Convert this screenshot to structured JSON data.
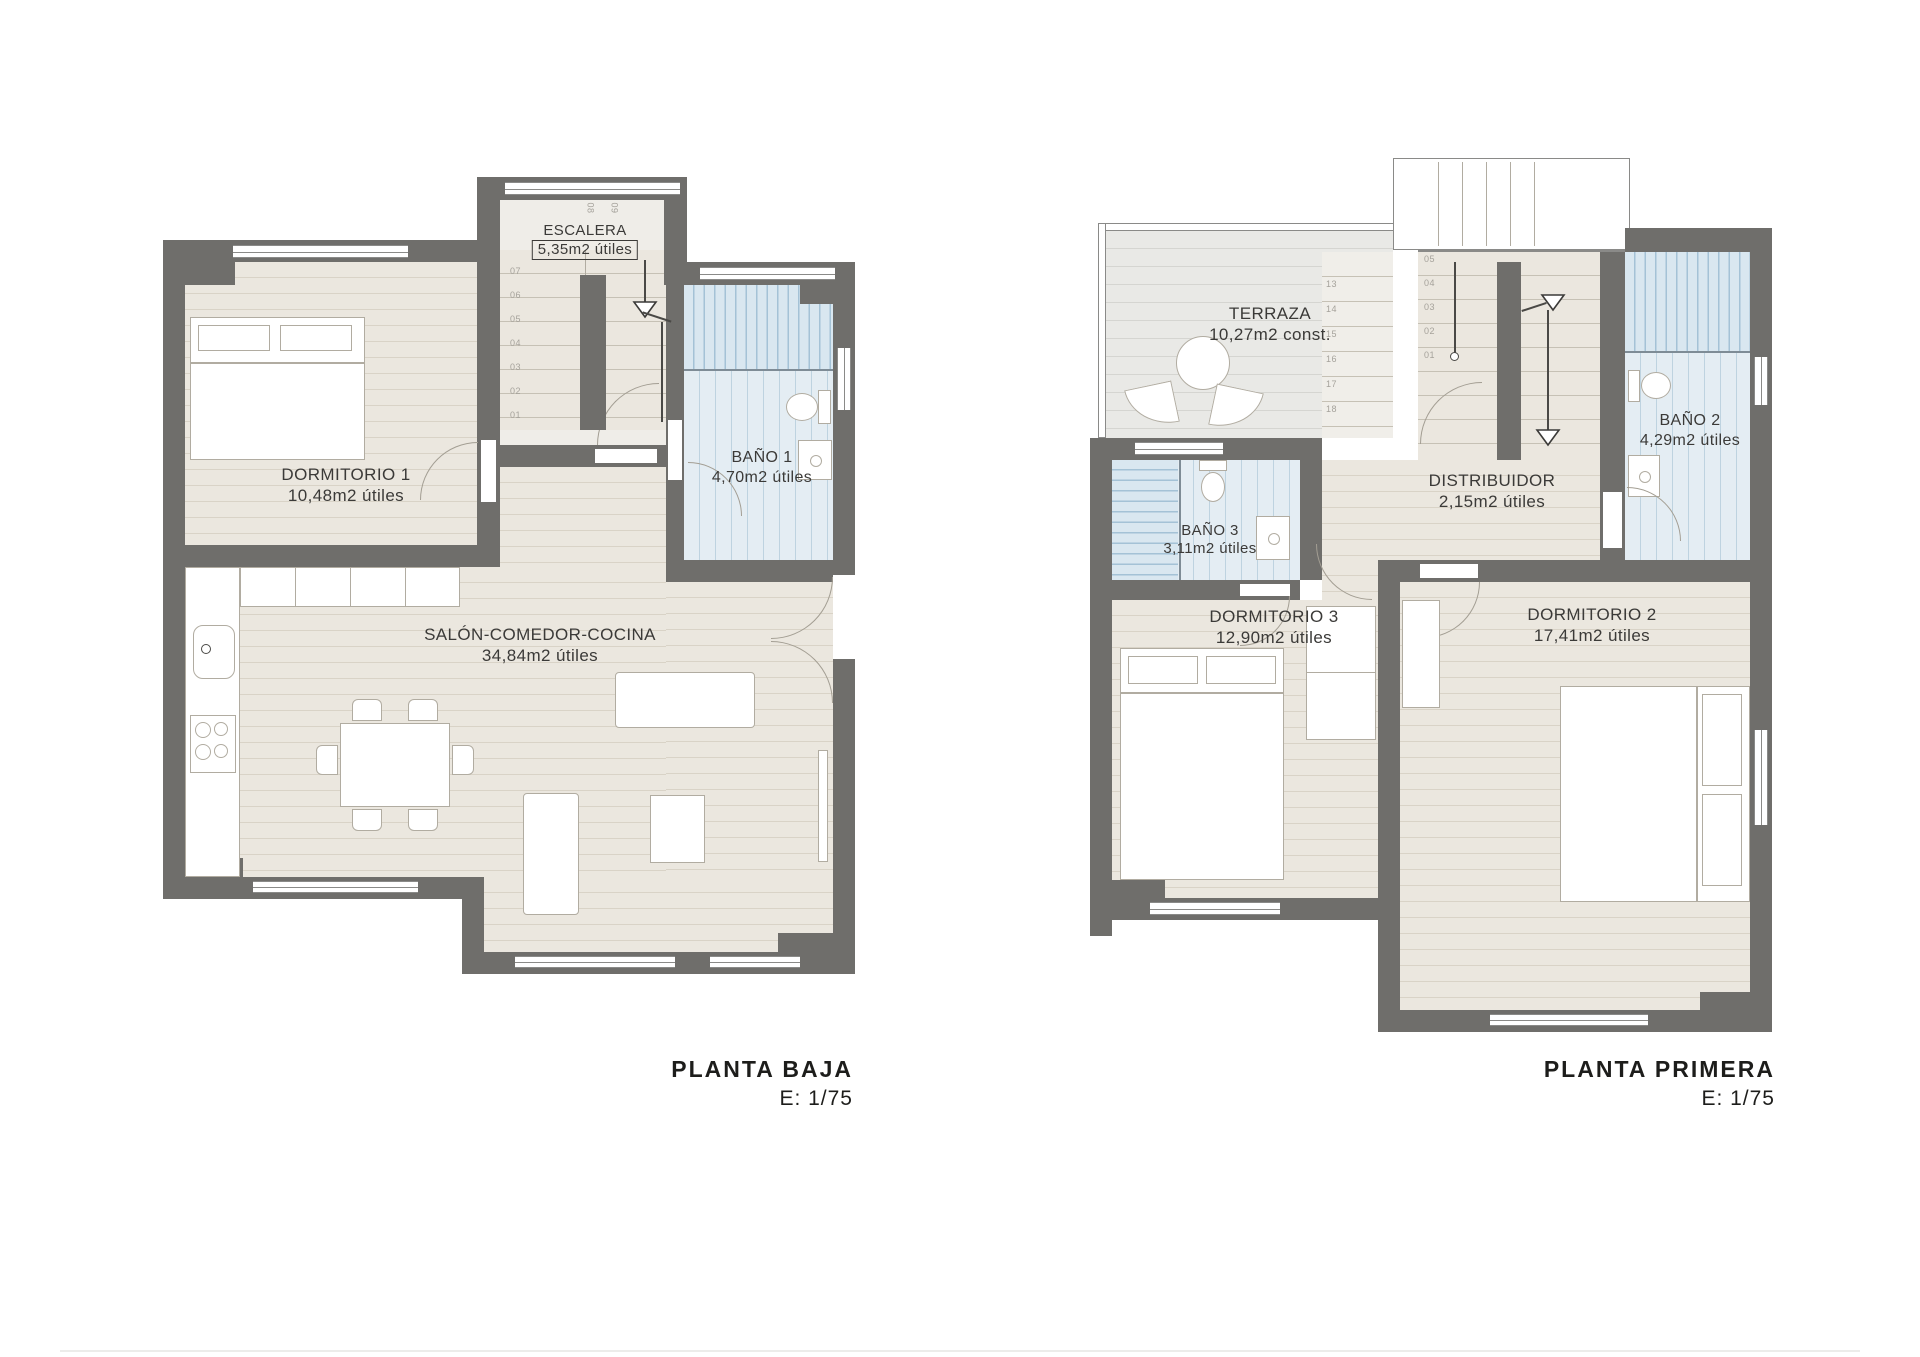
{
  "page": {
    "background": "#ffffff"
  },
  "colors": {
    "wall": "#6f6e6b",
    "outline": "#8a8a88",
    "wood-base": "#ebe7df",
    "wood-line": "#d9d3c7",
    "step-line": "#c6c1b5",
    "terrace-base": "#e9e9e6",
    "terrace-line": "#d5d5d1",
    "tile-base": "#e4edf3",
    "tile-line": "#bed3e0",
    "shower-base": "#d9e7f0",
    "shower-line": "#a4c2d6",
    "furn-border": "#b1aca1",
    "arc": "#a39e93",
    "text": "#3b3a38",
    "step-num": "#a5a29b",
    "title": "#1d1d1b"
  },
  "plans": [
    {
      "title": "PLANTA BAJA",
      "scale": "E: 1/75",
      "rooms": {
        "dormitorio1": {
          "name": "DORMITORIO 1",
          "area": "10,48m2 útiles"
        },
        "escalera": {
          "name": "ESCALERA",
          "area": "5,35m2 útiles"
        },
        "bano1": {
          "name": "BAÑO 1",
          "area": "4,70m2 útiles"
        },
        "salon": {
          "name": "SALÓN-COMEDOR-COCINA",
          "area": "34,84m2 útiles"
        }
      },
      "stair": {
        "steps_col": [
          "07",
          "06",
          "05",
          "04",
          "03",
          "02",
          "01"
        ],
        "steps_top": [
          "08",
          "09"
        ]
      }
    },
    {
      "title": "PLANTA PRIMERA",
      "scale": "E: 1/75",
      "rooms": {
        "terraza": {
          "name": "TERRAZA",
          "area": "10,27m2 const."
        },
        "bano2": {
          "name": "BAÑO 2",
          "area": "4,29m2 útiles"
        },
        "bano3": {
          "name": "BAÑO 3",
          "area": "3,11m2 útiles"
        },
        "distribuidor": {
          "name": "DISTRIBUIDOR",
          "area": "2,15m2 útiles"
        },
        "dormitorio3": {
          "name": "DORMITORIO 3",
          "area": "12,90m2 útiles"
        },
        "dormitorio2": {
          "name": "DORMITORIO 2",
          "area": "17,41m2 útiles"
        }
      },
      "stair": {
        "steps_col": [
          "05",
          "04",
          "03",
          "02",
          "01"
        ],
        "steps_col2": [
          "13",
          "14",
          "15",
          "16",
          "17",
          "18"
        ]
      }
    }
  ]
}
